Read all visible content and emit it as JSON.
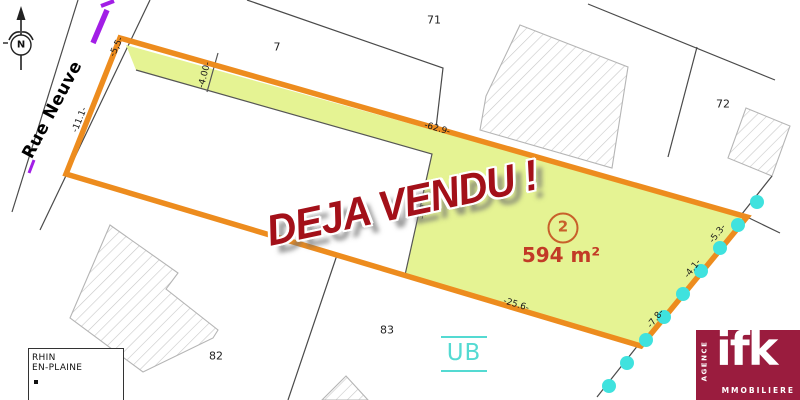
{
  "map": {
    "street": "Rue Neuve",
    "north": "N",
    "zone": "UB",
    "stamp": "DEJA VENDU !",
    "lot": {
      "number": "2",
      "area": "594 m²"
    },
    "parcels": [
      {
        "label": "71"
      },
      {
        "label": "7"
      },
      {
        "label": "72"
      },
      {
        "label": "82"
      },
      {
        "label": "83"
      }
    ],
    "dimensions": [
      {
        "label": "-5,5-"
      },
      {
        "label": "-11.1-"
      },
      {
        "label": "-4.00-"
      },
      {
        "label": "-62.9-"
      },
      {
        "label": "-12"
      },
      {
        "label": "-25.6-"
      },
      {
        "label": "-5.3-"
      },
      {
        "label": "-4.1-"
      },
      {
        "label": "-7.8-"
      }
    ],
    "title_block": {
      "line1": "RHIN",
      "line2": "EN-PLAINE"
    }
  },
  "logo": {
    "brand": "ifk",
    "agence": "AGENCE",
    "immobiliere": "MMOBILIERE"
  },
  "colors": {
    "boundary_orange": "#ED8C1E",
    "lot_fill_yellow": "#E5F393",
    "marker_cyan": "#3FE2DE",
    "zone_cyan": "#54DAD2",
    "stamp_red": "#A31019",
    "lot_label_red": "#C23A26",
    "logo_maroon": "#9A1C3E",
    "utility_purple": "#A21EE6"
  }
}
